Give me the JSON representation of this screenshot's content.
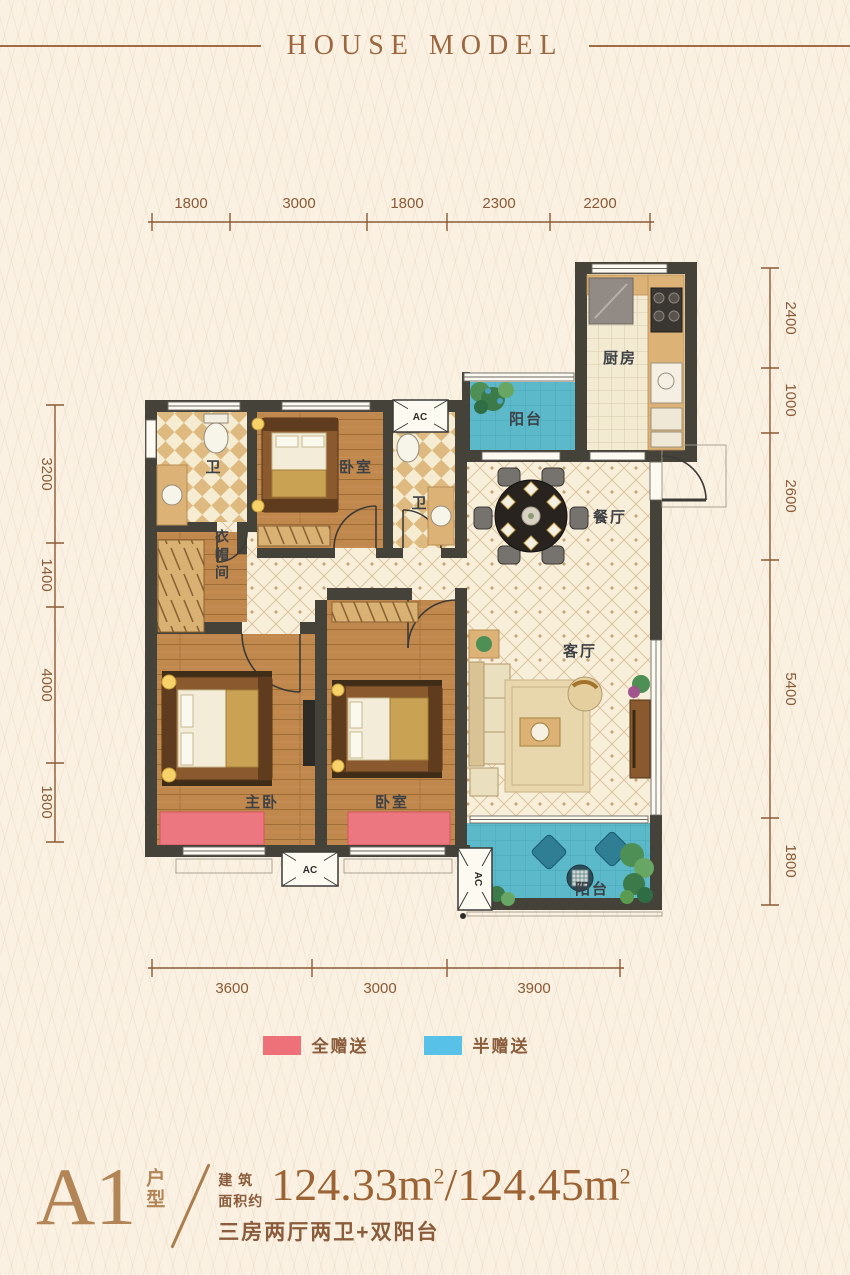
{
  "header": {
    "title": "HOUSE MODEL"
  },
  "dimensions": {
    "top": [
      "1800",
      "3000",
      "1800",
      "2300",
      "2200"
    ],
    "right": [
      "2400",
      "1000",
      "2600",
      "5400",
      "1800"
    ],
    "left": [
      "3200",
      "1400",
      "4000",
      "1800"
    ],
    "bottom": [
      "3600",
      "3000",
      "3900"
    ]
  },
  "rooms": {
    "kitchen": "厨房",
    "balcony_top": "阳台",
    "balcony_bottom": "阳台",
    "bath_top": "卫",
    "bath_mid": "卫",
    "bedroom_top": "卧室",
    "bedroom_second": "卧室",
    "master_bedroom": "主卧",
    "cloakroom": "衣帽间",
    "dining": "餐厅",
    "living": "客厅"
  },
  "ac_label": "AC",
  "legend": [
    {
      "label": "全赠送",
      "color": "#ee7179"
    },
    {
      "label": "半赠送",
      "color": "#58c1e7"
    }
  ],
  "footer": {
    "plan_code": "A1",
    "plan_type": "户型",
    "area_prefix_line1": "建 筑",
    "area_prefix_line2": "面积约",
    "area_1": "124.33m",
    "area_sup": "2",
    "area_divider": "/",
    "area_2": "124.45m",
    "description": "三房两厅两卫+双阳台"
  },
  "colors": {
    "wall": "#454239",
    "wood_floor": "#c1884e",
    "balcony": "#5cb9ca",
    "gift_full": "#ee7179",
    "gift_half": "#58c1e7",
    "dimension": "#8a5a36",
    "title": "#9c6740"
  }
}
